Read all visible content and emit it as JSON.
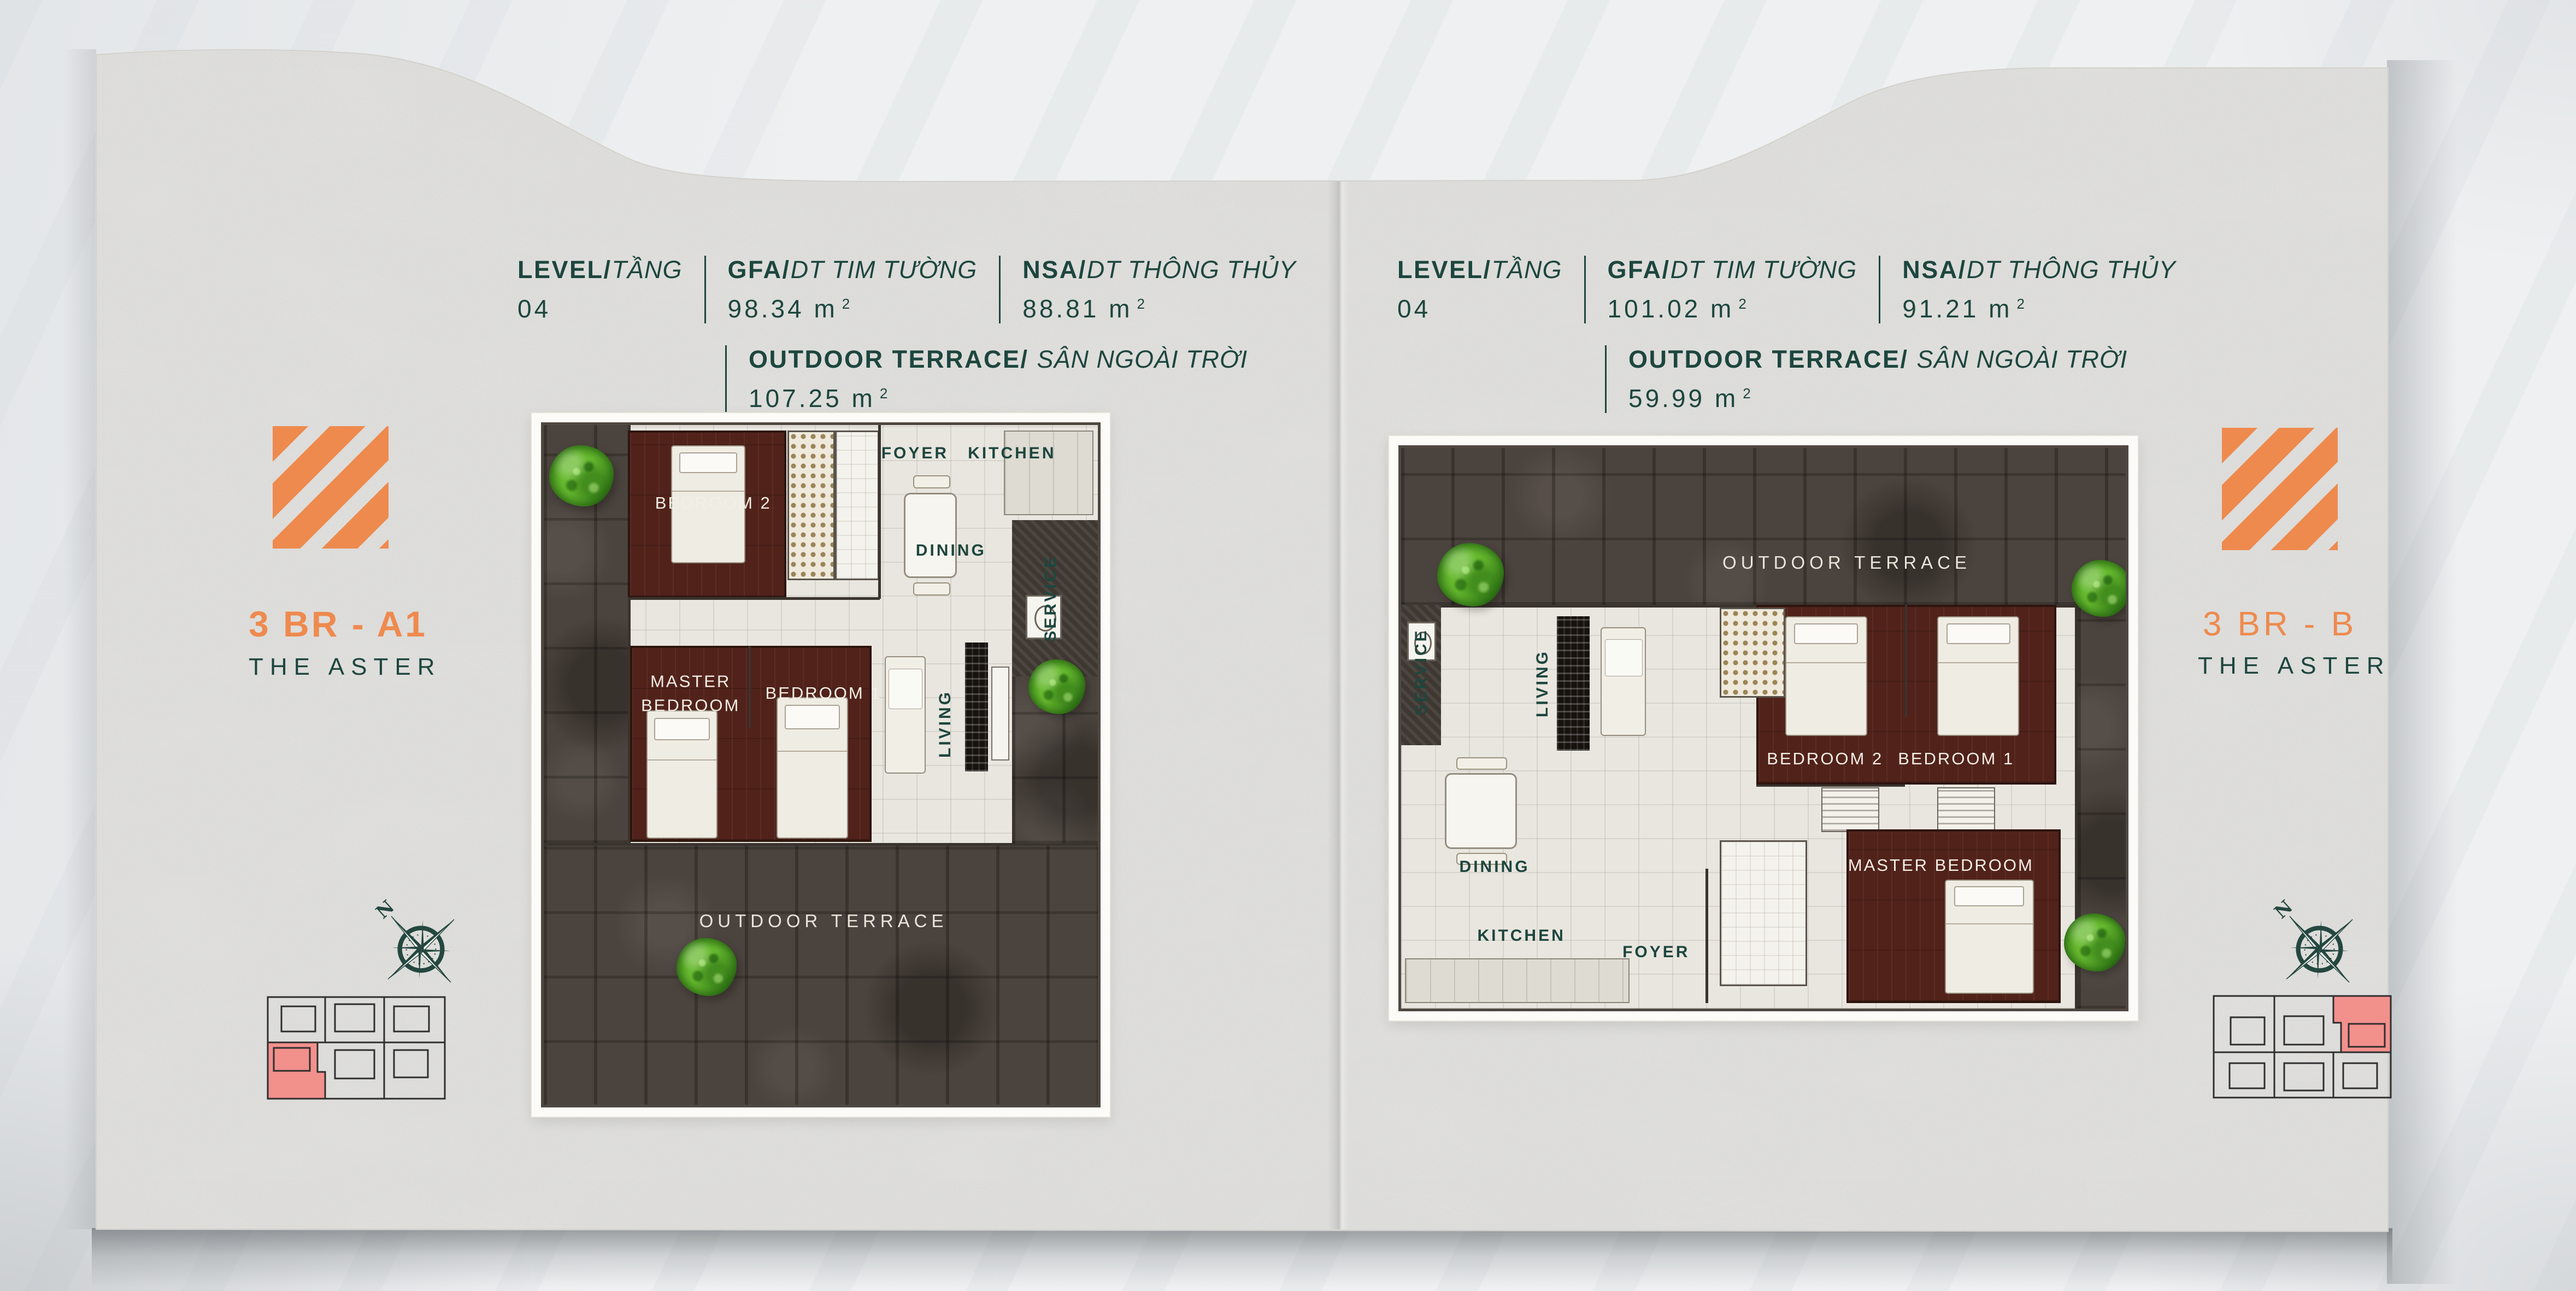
{
  "units": {
    "m": "m",
    "sup": "2"
  },
  "compass": {
    "n": "N"
  },
  "left": {
    "header": {
      "level": "LEVEL/",
      "level_it": "TẦNG",
      "level_value": "04",
      "gfa": "GFA/",
      "gfa_it": "DT TIM TƯỜNG",
      "gfa_value": "98.34",
      "nsa": "NSA/",
      "nsa_it": "DT THÔNG THỦY",
      "nsa_value": "88.81",
      "out": "OUTDOOR TERRACE/",
      "out_it": "SÂN NGOÀI TRỜI",
      "out_value": "107.25"
    },
    "logo": {
      "unit": "3 BR - A1",
      "project": "THE ASTER"
    },
    "rooms": {
      "bedroom2": "BEDROOM 2",
      "foyer": "FOYER",
      "kitchen": "KITCHEN",
      "dining": "DINING",
      "service": "SERVICE",
      "living": "LIVING",
      "master": "MASTER BEDROOM",
      "bedroom1": "BEDROOM 1",
      "terrace": "OUTDOOR TERRACE"
    }
  },
  "right": {
    "header": {
      "level": "LEVEL/",
      "level_it": "TẦNG",
      "level_value": "04",
      "gfa": "GFA/",
      "gfa_it": "DT TIM TƯỜNG",
      "gfa_value": "101.02",
      "nsa": "NSA/",
      "nsa_it": "DT THÔNG THỦY",
      "nsa_value": "91.21",
      "out": "OUTDOOR TERRACE/",
      "out_it": "SÂN NGOÀI TRỜI",
      "out_value": "59.99"
    },
    "logo": {
      "unit": "3 BR - B",
      "project": "THE ASTER"
    },
    "rooms": {
      "terrace": "OUTDOOR TERRACE",
      "service": "SERVICE",
      "living": "LIVING",
      "bedroom2": "BEDROOM 2",
      "bedroom1": "BEDROOM 1",
      "master": "MASTER BEDROOM",
      "dining": "DINING",
      "kitchen": "KITCHEN",
      "foyer": "FOYER"
    }
  },
  "colors": {
    "accent_orange": "#ee8a4e",
    "brand_teal": "#1d463e",
    "highlight_pink": "#f2908c",
    "paper": "#f3f3f1",
    "terrace_stone": "#4b433d",
    "bedroom_wood": "#51221a"
  }
}
